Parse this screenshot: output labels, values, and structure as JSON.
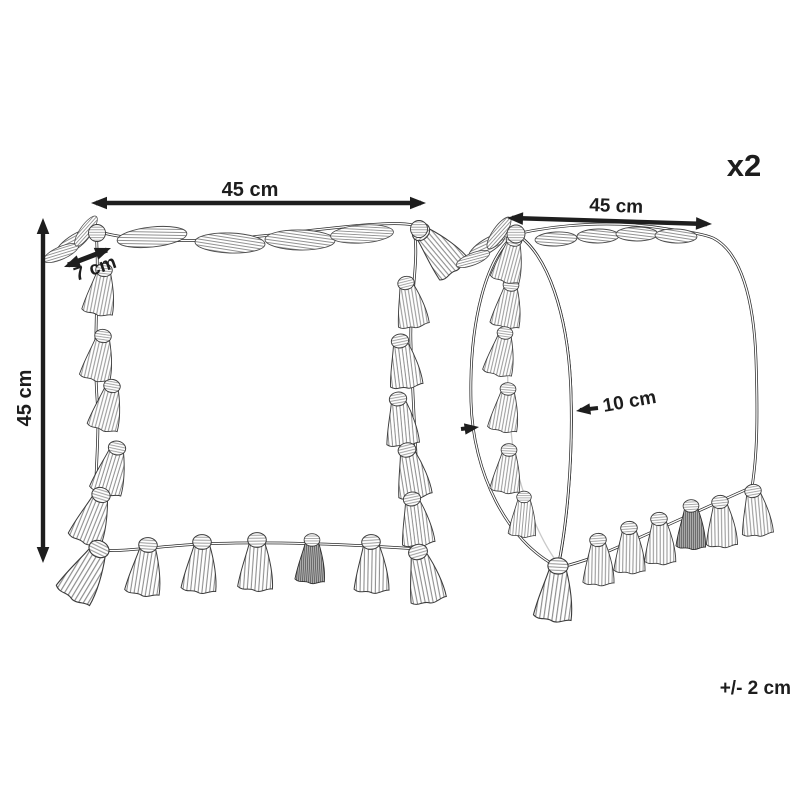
{
  "diagram": {
    "quantity": "x2",
    "tolerance": "+/- 2 cm",
    "front_view": {
      "width": "45 cm",
      "height": "45 cm",
      "tassel_length": "7 cm"
    },
    "side_view": {
      "width": "45 cm",
      "depth": "10 cm"
    },
    "colors": {
      "line": "#2b2b2b",
      "text": "#1d1d1d",
      "hatch": "#8c8c8c"
    }
  }
}
